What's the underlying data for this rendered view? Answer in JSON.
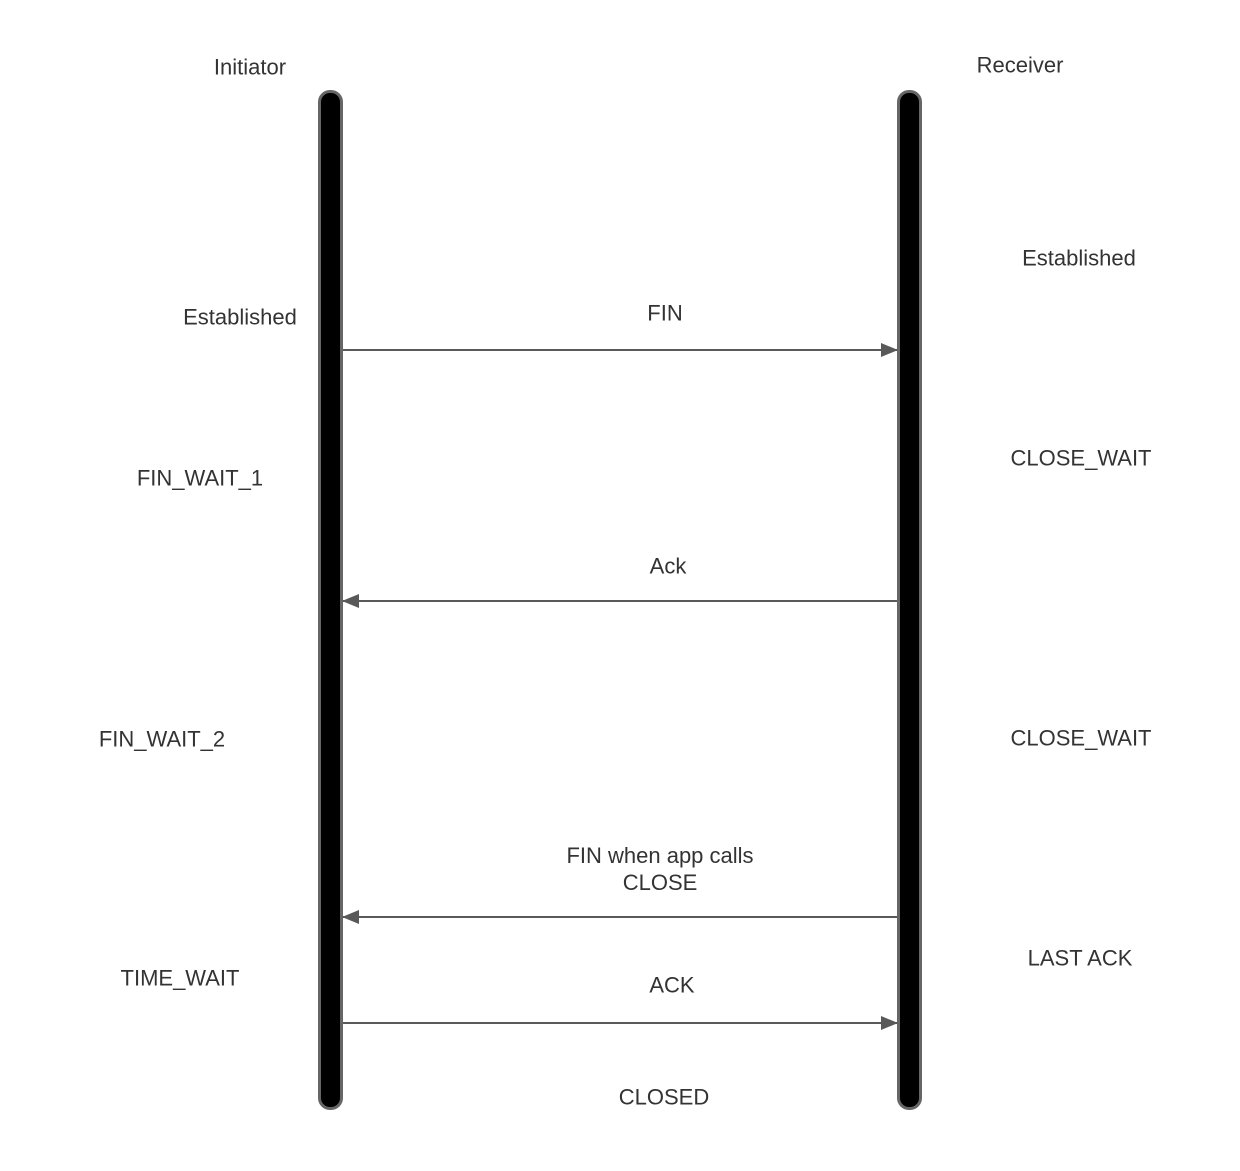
{
  "diagram_type": "sequence",
  "actors": [
    {
      "label": "Initiator"
    },
    {
      "label": "Receiver"
    }
  ],
  "initiator_states": [
    {
      "label": "Established"
    },
    {
      "label": "FIN_WAIT_1"
    },
    {
      "label": "FIN_WAIT_2"
    },
    {
      "label": "TIME_WAIT"
    }
  ],
  "receiver_states": [
    {
      "label": "Established"
    },
    {
      "label": "CLOSE_WAIT"
    },
    {
      "label": "CLOSE_WAIT"
    },
    {
      "label": "LAST ACK"
    }
  ],
  "messages": [
    {
      "label": "FIN",
      "from": "Initiator",
      "to": "Receiver",
      "direction": "right"
    },
    {
      "label": "Ack",
      "from": "Receiver",
      "to": "Initiator",
      "direction": "left"
    },
    {
      "label": "FIN when app calls\nCLOSE",
      "from": "Receiver",
      "to": "Initiator",
      "direction": "left"
    },
    {
      "label": "ACK",
      "from": "Initiator",
      "to": "Receiver",
      "direction": "right"
    }
  ],
  "final_state": {
    "label": "CLOSED"
  },
  "colors": {
    "background": "#ffffff",
    "text": "#333333",
    "arrow": "#595959",
    "lifeline_fill": "#000000",
    "lifeline_border": "#666666"
  }
}
